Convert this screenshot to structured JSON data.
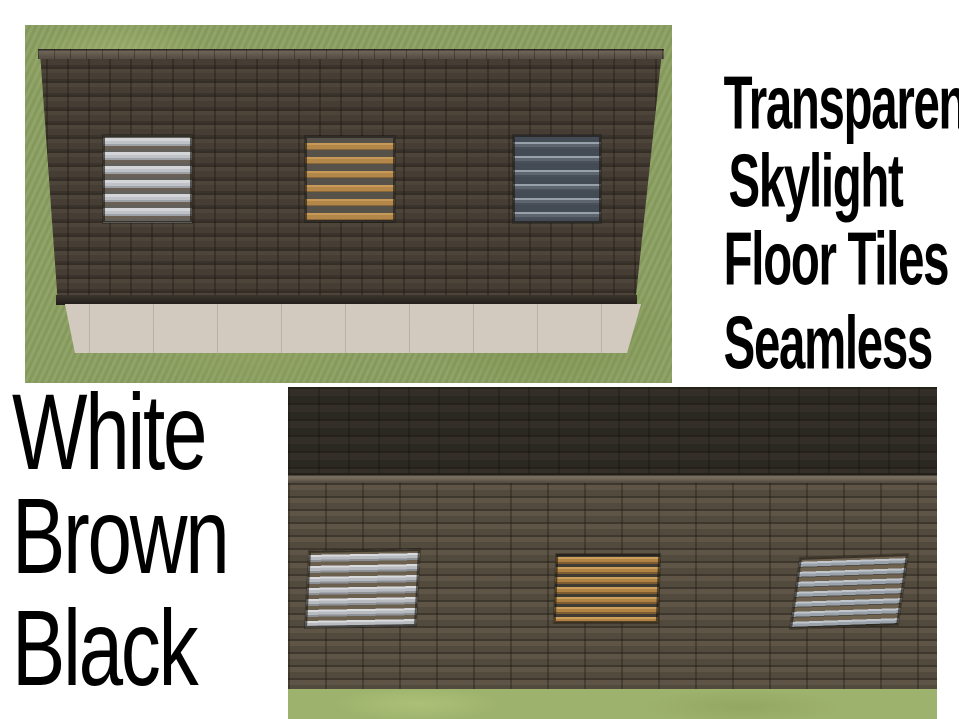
{
  "title": {
    "lines": [
      "Transparent",
      "Skylight",
      "Floor Tiles"
    ],
    "tagline": "Seamless",
    "text_color": "#000000"
  },
  "variants": [
    "White",
    "Brown",
    "Black"
  ],
  "photos": {
    "top": {
      "skylights": [
        "white",
        "brown",
        "black"
      ]
    },
    "bottom": {
      "skylights": [
        "white",
        "brown",
        "black"
      ]
    }
  },
  "palette": {
    "page_background": "#ffffff",
    "grass_top_photo": "#8a9e60",
    "grass_bottom_photo": "#9db26c",
    "roof_shingle": "#463e34",
    "roof_shingle_gap": "#342e27",
    "roof_far_slope": "#2d2924",
    "ridge_cap": "#6f6558",
    "wall": "#d6ccc1",
    "skylight_white_slat": "#c2c5c9",
    "skylight_brown_slat": "#b3874a",
    "skylight_black_body": "#49505a",
    "skylight_black_slat": "#97a1ab"
  }
}
